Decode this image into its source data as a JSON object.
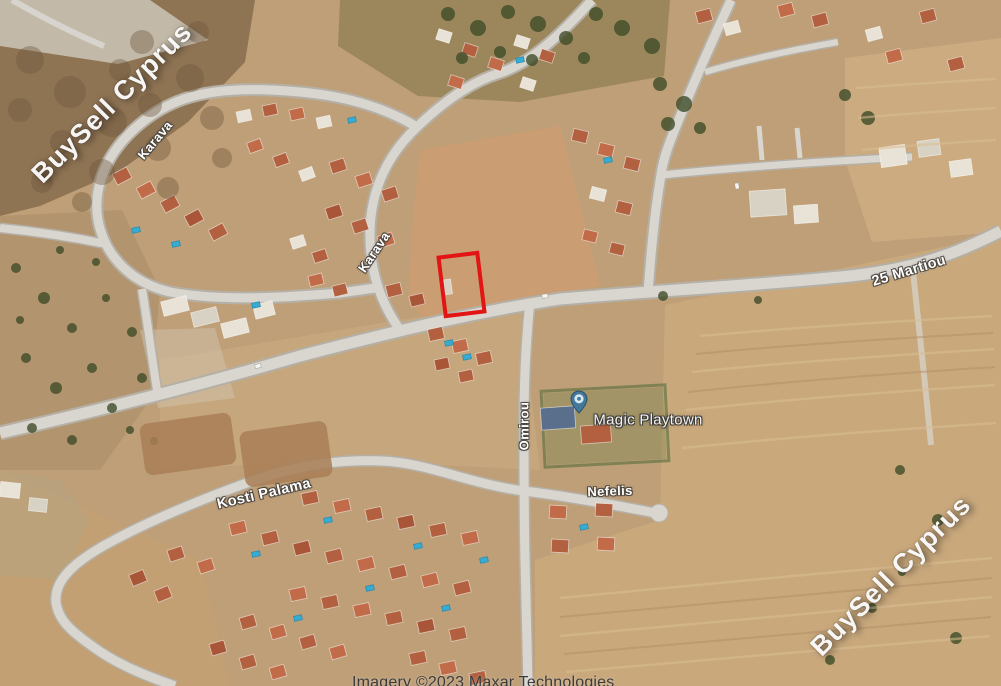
{
  "map": {
    "watermark": {
      "text": "BuySell Cyprus",
      "color": "#ffffff"
    },
    "roads": {
      "karava_1": "Karava",
      "karava_2": "Karava",
      "martiou": "25 Martiou",
      "omirou": "Omirou",
      "kosti_palama": "Kosti Palama",
      "nefelis": "Nefelis"
    },
    "poi": {
      "magic_playtown": {
        "label": "Magic Playtown",
        "pin_color": "#44789a"
      }
    },
    "plot": {
      "outline_color": "#e21414"
    },
    "attribution": "Imagery ©2023 Maxar Technologies"
  }
}
